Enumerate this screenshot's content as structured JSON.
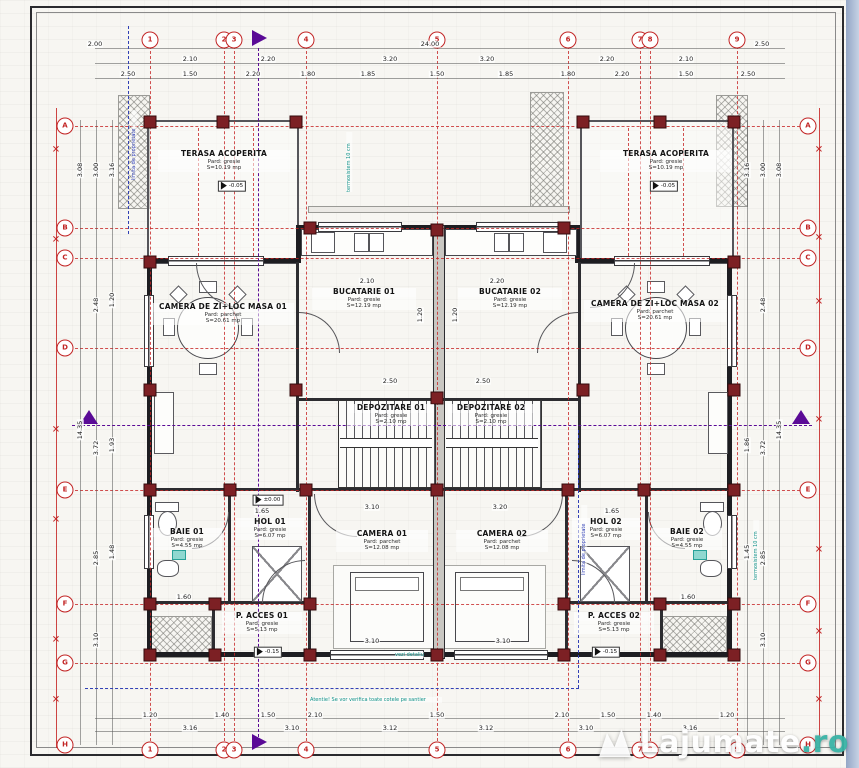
{
  "watermark": {
    "main": "Lajumate",
    "suffix": ".ro"
  },
  "colors": {
    "axis_red": "#c22424",
    "wall": "#1d1d21",
    "column": "#7c2024",
    "section_purple": "#5a0a96",
    "property_blue": "#3140b5",
    "note_teal": "#0c8f86",
    "watermark_ro": "#39b3a6"
  },
  "rooms": [
    {
      "name": "TERASA ACOPERITA",
      "floor": "Pard: gresie",
      "area": "S=10.19 mp",
      "style": "left:158px;top:150px;width:132px"
    },
    {
      "name": "TERASA ACOPERITA",
      "floor": "Pard: gresie",
      "area": "S=10.19 mp",
      "style": "left:600px;top:150px;width:132px"
    },
    {
      "name": "BUCATARIE 01",
      "floor": "Pard: gresie",
      "area": "S=12.19 mp",
      "style": "left:312px;top:288px;width:104px"
    },
    {
      "name": "BUCATARIE 02",
      "floor": "Pard: gresie",
      "area": "S=12.19 mp",
      "style": "left:458px;top:288px;width:104px"
    },
    {
      "name": "CAMERA DE ZI+LOC MASA 01",
      "floor": "Pard: parchet",
      "area": "S=20.61 mp",
      "style": "left:152px;top:303px;width:142px"
    },
    {
      "name": "CAMERA DE ZI+LOC MASA 02",
      "floor": "Pard: parchet",
      "area": "S=20.61 mp",
      "style": "left:584px;top:300px;width:142px"
    },
    {
      "name": "DEPOZITARE 01",
      "floor": "Pard: gresie",
      "area": "S=2.10 mp",
      "style": "left:348px;top:404px;width:86px"
    },
    {
      "name": "DEPOZITARE 02",
      "floor": "Pard: gresie",
      "area": "S=2.10 mp",
      "style": "left:448px;top:404px;width:86px"
    },
    {
      "name": "BAIE 01",
      "floor": "Pard: gresie",
      "area": "S=4.55 mp",
      "style": "left:152px;top:528px;width:70px"
    },
    {
      "name": "HOL 01",
      "floor": "Pard: gresie",
      "area": "S=6.07 mp",
      "style": "left:236px;top:518px;width:68px"
    },
    {
      "name": "HOL 02",
      "floor": "Pard: gresie",
      "area": "S=6.07 mp",
      "style": "left:572px;top:518px;width:68px"
    },
    {
      "name": "BAIE 02",
      "floor": "Pard: gresie",
      "area": "S=4.55 mp",
      "style": "left:652px;top:528px;width:70px"
    },
    {
      "name": "CAMERA 01",
      "floor": "Pard: parchet",
      "area": "S=12.08 mp",
      "style": "left:336px;top:530px;width:92px"
    },
    {
      "name": "CAMERA 02",
      "floor": "Pard: parchet",
      "area": "S=12.08 mp",
      "style": "left:456px;top:530px;width:92px"
    },
    {
      "name": "P. ACCES 01",
      "floor": "Pard: gresie",
      "area": "S=5.13 mp",
      "style": "left:222px;top:612px;width:80px"
    },
    {
      "name": "P. ACCES 02",
      "floor": "Pard: gresie",
      "area": "S=5.13 mp",
      "style": "left:574px;top:612px;width:80px"
    }
  ],
  "axes": {
    "v": [
      {
        "style": "left:150px;top:46px;height:700px"
      },
      {
        "style": "left:224px;top:46px;height:700px"
      },
      {
        "style": "left:234px;top:46px;height:700px"
      },
      {
        "style": "left:306px;top:46px;height:700px"
      },
      {
        "style": "left:437px;top:46px;height:700px"
      },
      {
        "style": "left:568px;top:46px;height:700px"
      },
      {
        "style": "left:640px;top:46px;height:700px"
      },
      {
        "style": "left:650px;top:46px;height:700px"
      },
      {
        "style": "left:737px;top:46px;height:700px"
      },
      {
        "style": "left:198px;top:128px;height:128px"
      },
      {
        "style": "left:253px;top:128px;height:128px"
      },
      {
        "style": "left:628px;top:128px;height:128px"
      },
      {
        "style": "left:683px;top:128px;height:128px"
      }
    ],
    "h": [
      {
        "style": "top:126px;left:70px;width:730px"
      },
      {
        "style": "top:228px;left:70px;width:730px"
      },
      {
        "style": "top:258px;left:70px;width:730px"
      },
      {
        "style": "top:348px;left:70px;width:730px"
      },
      {
        "style": "top:490px;left:70px;width:730px"
      },
      {
        "style": "top:604px;left:70px;width:730px"
      },
      {
        "style": "top:663px;left:70px;width:730px"
      }
    ]
  },
  "bubbles": {
    "top": [
      {
        "t": "1",
        "style": "left:150px;top:40px"
      },
      {
        "t": "2",
        "style": "left:224px;top:40px"
      },
      {
        "t": "3",
        "style": "left:234px;top:40px"
      },
      {
        "t": "4",
        "style": "left:306px;top:40px"
      },
      {
        "t": "5",
        "style": "left:437px;top:40px"
      },
      {
        "t": "6",
        "style": "left:568px;top:40px"
      },
      {
        "t": "7",
        "style": "left:640px;top:40px"
      },
      {
        "t": "8",
        "style": "left:650px;top:40px"
      },
      {
        "t": "9",
        "style": "left:737px;top:40px"
      }
    ],
    "bottom": [
      {
        "t": "1",
        "style": "left:150px;top:750px"
      },
      {
        "t": "2",
        "style": "left:224px;top:750px"
      },
      {
        "t": "3",
        "style": "left:234px;top:750px"
      },
      {
        "t": "4",
        "style": "left:306px;top:750px"
      },
      {
        "t": "5",
        "style": "left:437px;top:750px"
      },
      {
        "t": "6",
        "style": "left:568px;top:750px"
      },
      {
        "t": "7",
        "style": "left:640px;top:750px"
      },
      {
        "t": "8",
        "style": "left:650px;top:750px"
      },
      {
        "t": "9",
        "style": "left:737px;top:750px"
      }
    ],
    "left": [
      {
        "t": "A",
        "style": "left:65px;top:126px"
      },
      {
        "t": "B",
        "style": "left:65px;top:228px"
      },
      {
        "t": "C",
        "style": "left:65px;top:258px"
      },
      {
        "t": "D",
        "style": "left:65px;top:348px"
      },
      {
        "t": "E",
        "style": "left:65px;top:490px"
      },
      {
        "t": "F",
        "style": "left:65px;top:604px"
      },
      {
        "t": "G",
        "style": "left:65px;top:663px"
      },
      {
        "t": "H",
        "style": "left:65px;top:745px"
      }
    ],
    "right": [
      {
        "t": "A",
        "style": "left:808px;top:126px"
      },
      {
        "t": "B",
        "style": "left:808px;top:228px"
      },
      {
        "t": "C",
        "style": "left:808px;top:258px"
      },
      {
        "t": "D",
        "style": "left:808px;top:348px"
      },
      {
        "t": "E",
        "style": "left:808px;top:490px"
      },
      {
        "t": "F",
        "style": "left:808px;top:604px"
      },
      {
        "t": "G",
        "style": "left:808px;top:663px"
      },
      {
        "t": "H",
        "style": "left:808px;top:745px"
      }
    ]
  },
  "xmarks": [
    {
      "style": "left:56px;top:150px"
    },
    {
      "style": "left:56px;top:240px"
    },
    {
      "style": "left:56px;top:430px"
    },
    {
      "style": "left:56px;top:520px"
    },
    {
      "style": "left:56px;top:640px"
    },
    {
      "style": "left:56px;top:700px"
    },
    {
      "style": "left:819px;top:150px"
    },
    {
      "style": "left:819px;top:238px"
    },
    {
      "style": "left:819px;top:302px"
    },
    {
      "style": "left:819px;top:420px"
    },
    {
      "style": "left:819px;top:550px"
    },
    {
      "style": "left:819px;top:632px"
    },
    {
      "style": "left:819px;top:700px"
    }
  ],
  "columns": [
    {
      "style": "left:150px;top:122px"
    },
    {
      "style": "left:223px;top:122px"
    },
    {
      "style": "left:296px;top:122px"
    },
    {
      "style": "left:583px;top:122px"
    },
    {
      "style": "left:660px;top:122px"
    },
    {
      "style": "left:734px;top:122px"
    },
    {
      "style": "left:310px;top:228px"
    },
    {
      "style": "left:437px;top:230px"
    },
    {
      "style": "left:564px;top:228px"
    },
    {
      "style": "left:150px;top:262px"
    },
    {
      "style": "left:734px;top:262px"
    },
    {
      "style": "left:150px;top:390px"
    },
    {
      "style": "left:296px;top:390px"
    },
    {
      "style": "left:437px;top:398px"
    },
    {
      "style": "left:583px;top:390px"
    },
    {
      "style": "left:734px;top:390px"
    },
    {
      "style": "left:150px;top:490px"
    },
    {
      "style": "left:230px;top:490px"
    },
    {
      "style": "left:306px;top:490px"
    },
    {
      "style": "left:437px;top:490px"
    },
    {
      "style": "left:568px;top:490px"
    },
    {
      "style": "left:644px;top:490px"
    },
    {
      "style": "left:734px;top:490px"
    },
    {
      "style": "left:150px;top:604px"
    },
    {
      "style": "left:215px;top:604px"
    },
    {
      "style": "left:310px;top:604px"
    },
    {
      "style": "left:564px;top:604px"
    },
    {
      "style": "left:660px;top:604px"
    },
    {
      "style": "left:734px;top:604px"
    },
    {
      "style": "left:150px;top:655px"
    },
    {
      "style": "left:215px;top:655px"
    },
    {
      "style": "left:310px;top:655px"
    },
    {
      "style": "left:437px;top:655px"
    },
    {
      "style": "left:564px;top:655px"
    },
    {
      "style": "left:660px;top:655px"
    },
    {
      "style": "left:734px;top:655px"
    }
  ],
  "dims": {
    "top": [
      {
        "v": "2.00",
        "style": "left:95px;top:44px"
      },
      {
        "v": "24.00",
        "style": "left:430px;top:44px"
      },
      {
        "v": "2.50",
        "style": "left:762px;top:44px"
      },
      {
        "v": "2.10",
        "style": "left:190px;top:59px"
      },
      {
        "v": "2.20",
        "style": "left:268px;top:59px"
      },
      {
        "v": "3.20",
        "style": "left:390px;top:59px"
      },
      {
        "v": "3.20",
        "style": "left:487px;top:59px"
      },
      {
        "v": "2.20",
        "style": "left:607px;top:59px"
      },
      {
        "v": "2.10",
        "style": "left:686px;top:59px"
      },
      {
        "v": "2.50",
        "style": "left:128px;top:74px"
      },
      {
        "v": "1.50",
        "style": "left:190px;top:74px"
      },
      {
        "v": "2.20",
        "style": "left:253px;top:74px"
      },
      {
        "v": "1.80",
        "style": "left:308px;top:74px"
      },
      {
        "v": "1.85",
        "style": "left:368px;top:74px"
      },
      {
        "v": "1.50",
        "style": "left:437px;top:74px"
      },
      {
        "v": "1.85",
        "style": "left:506px;top:74px"
      },
      {
        "v": "1.80",
        "style": "left:568px;top:74px"
      },
      {
        "v": "2.20",
        "style": "left:622px;top:74px"
      },
      {
        "v": "1.50",
        "style": "left:686px;top:74px"
      },
      {
        "v": "2.50",
        "style": "left:748px;top:74px"
      }
    ],
    "bottom": [
      {
        "v": "1.20",
        "style": "left:150px;top:715px"
      },
      {
        "v": "1.40",
        "style": "left:222px;top:715px"
      },
      {
        "v": "1.50",
        "style": "left:268px;top:715px"
      },
      {
        "v": "2.10",
        "style": "left:315px;top:715px"
      },
      {
        "v": "1.50",
        "style": "left:437px;top:715px"
      },
      {
        "v": "2.10",
        "style": "left:562px;top:715px"
      },
      {
        "v": "1.50",
        "style": "left:608px;top:715px"
      },
      {
        "v": "1.40",
        "style": "left:654px;top:715px"
      },
      {
        "v": "1.20",
        "style": "left:727px;top:715px"
      },
      {
        "v": "3.16",
        "style": "left:190px;top:728px"
      },
      {
        "v": "3.10",
        "style": "left:292px;top:728px"
      },
      {
        "v": "3.12",
        "style": "left:390px;top:728px"
      },
      {
        "v": "3.12",
        "style": "left:486px;top:728px"
      },
      {
        "v": "3.10",
        "style": "left:586px;top:728px"
      },
      {
        "v": "3.16",
        "style": "left:690px;top:728px"
      }
    ],
    "left": [
      {
        "v": "3.08",
        "style": "left:80px;top:170px;transform:translate(-50%,-50%) rotate(-90deg)"
      },
      {
        "v": "3.00",
        "style": "left:96px;top:170px;transform:translate(-50%,-50%) rotate(-90deg)"
      },
      {
        "v": "3.16",
        "style": "left:112px;top:170px;transform:translate(-50%,-50%) rotate(-90deg)"
      },
      {
        "v": "2.48",
        "style": "left:96px;top:305px;transform:translate(-50%,-50%) rotate(-90deg)"
      },
      {
        "v": "1.20",
        "style": "left:112px;top:300px;transform:translate(-50%,-50%) rotate(-90deg)"
      },
      {
        "v": "3.72",
        "style": "left:96px;top:448px;transform:translate(-50%,-50%) rotate(-90deg)"
      },
      {
        "v": "1.93",
        "style": "left:112px;top:445px;transform:translate(-50%,-50%) rotate(-90deg)"
      },
      {
        "v": "2.85",
        "style": "left:96px;top:558px;transform:translate(-50%,-50%) rotate(-90deg)"
      },
      {
        "v": "1.48",
        "style": "left:112px;top:552px;transform:translate(-50%,-50%) rotate(-90deg)"
      },
      {
        "v": "3.10",
        "style": "left:96px;top:640px;transform:translate(-50%,-50%) rotate(-90deg)"
      },
      {
        "v": "14.35",
        "style": "left:80px;top:430px;transform:translate(-50%,-50%) rotate(-90deg)"
      }
    ],
    "right": [
      {
        "v": "3.08",
        "style": "left:779px;top:170px;transform:translate(-50%,-50%) rotate(-90deg)"
      },
      {
        "v": "3.00",
        "style": "left:763px;top:170px;transform:translate(-50%,-50%) rotate(-90deg)"
      },
      {
        "v": "3.16",
        "style": "left:747px;top:170px;transform:translate(-50%,-50%) rotate(-90deg)"
      },
      {
        "v": "2.48",
        "style": "left:763px;top:305px;transform:translate(-50%,-50%) rotate(-90deg)"
      },
      {
        "v": "3.72",
        "style": "left:763px;top:448px;transform:translate(-50%,-50%) rotate(-90deg)"
      },
      {
        "v": "1.86",
        "style": "left:747px;top:445px;transform:translate(-50%,-50%) rotate(-90deg)"
      },
      {
        "v": "2.85",
        "style": "left:763px;top:558px;transform:translate(-50%,-50%) rotate(-90deg)"
      },
      {
        "v": "1.45",
        "style": "left:747px;top:552px;transform:translate(-50%,-50%) rotate(-90deg)"
      },
      {
        "v": "3.10",
        "style": "left:763px;top:640px;transform:translate(-50%,-50%) rotate(-90deg)"
      },
      {
        "v": "14.35",
        "style": "left:779px;top:430px;transform:translate(-50%,-50%) rotate(-90deg)"
      }
    ],
    "inner": [
      {
        "v": "2.10",
        "style": "left:367px;top:281px"
      },
      {
        "v": "2.20",
        "style": "left:497px;top:281px"
      },
      {
        "v": "2.50",
        "style": "left:390px;top:381px"
      },
      {
        "v": "2.50",
        "style": "left:483px;top:381px"
      },
      {
        "v": "3.10",
        "style": "left:372px;top:507px"
      },
      {
        "v": "3.20",
        "style": "left:500px;top:507px"
      },
      {
        "v": "3.10",
        "style": "left:372px;top:641px"
      },
      {
        "v": "3.10",
        "style": "left:503px;top:641px"
      },
      {
        "v": "1.65",
        "style": "left:262px;top:511px"
      },
      {
        "v": "1.65",
        "style": "left:612px;top:511px"
      },
      {
        "v": "1.60",
        "style": "left:184px;top:597px"
      },
      {
        "v": "1.60",
        "style": "left:688px;top:597px"
      },
      {
        "v": "1.20",
        "style": "left:420px;top:315px;transform:translate(-50%,-50%) rotate(-90deg)"
      },
      {
        "v": "1.20",
        "style": "left:455px;top:315px;transform:translate(-50%,-50%) rotate(-90deg)"
      }
    ]
  },
  "notes": [
    {
      "t": "termosistem 10 cm",
      "cls": "vert",
      "style": "left:346px;top:132px;height:60px"
    },
    {
      "t": "termosistem 10 cm",
      "cls": "vert",
      "style": "left:753px;top:520px;height:60px"
    },
    {
      "t": "limita de proprietate",
      "cls": "iv vert",
      "style": "left:131px;top:110px;height:70px"
    },
    {
      "t": "limita de proprietate",
      "cls": "iv vert",
      "style": "left:581px;top:505px;height:70px"
    },
    {
      "t": "Atentie! Se vor verifica toate cotele pe santier",
      "style": "left:310px;top:697px;width:132px"
    },
    {
      "t": "vezi detaliu",
      "style": "left:395px;top:652px"
    }
  ],
  "levels": [
    {
      "t": "-0.05",
      "style": "left:232px;top:186px"
    },
    {
      "t": "-0.05",
      "style": "left:664px;top:186px"
    },
    {
      "t": "±0.00",
      "style": "left:268px;top:500px"
    },
    {
      "t": "-0.15",
      "style": "left:268px;top:652px"
    },
    {
      "t": "-0.15",
      "style": "left:606px;top:652px"
    }
  ]
}
